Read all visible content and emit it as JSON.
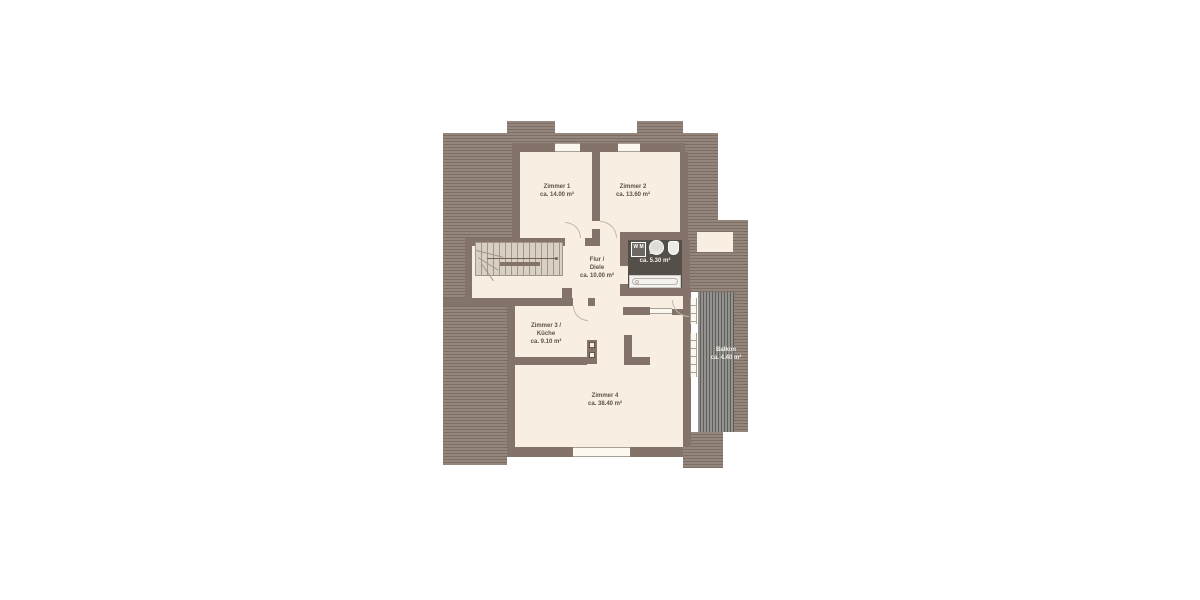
{
  "plan": {
    "type": "floor-plan",
    "rooms": [
      {
        "id": "zimmer-1",
        "lines": [
          "Zimmer 1",
          "ca. 14.00 m²"
        ]
      },
      {
        "id": "zimmer-2",
        "lines": [
          "Zimmer 2",
          "ca. 13.60 m²"
        ]
      },
      {
        "id": "flur-diele",
        "lines": [
          "Flur /",
          "Diele",
          "ca. 10.00 m²"
        ]
      },
      {
        "id": "bad",
        "lines": [
          "Bad",
          "ca. 5.30 m²"
        ]
      },
      {
        "id": "zimmer-3-kueche",
        "lines": [
          "Zimmer 3 /",
          "Küche",
          "ca. 9.10 m²"
        ]
      },
      {
        "id": "zimmer-4",
        "lines": [
          "Zimmer 4",
          "ca. 38.40 m²"
        ]
      },
      {
        "id": "balkon",
        "lines": [
          "Balkon",
          "ca. 4.40 m²"
        ]
      }
    ],
    "fixtures": {
      "washing_machine": {
        "lines": [
          "W",
          "M"
        ]
      }
    },
    "colors": {
      "roof_hatch": "#95867d",
      "roof_hatch_line": "#7c6e65",
      "wall": "#83736a",
      "floor": "#f8efe2",
      "bath_floor": "#544f49",
      "balcony_deck": "#94928f",
      "label_text": "#5c5349",
      "label_text_light": "#f4f1ec"
    }
  }
}
